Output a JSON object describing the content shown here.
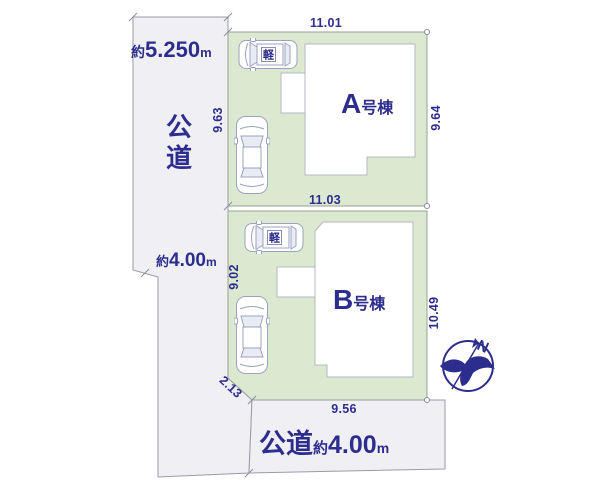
{
  "diagram": {
    "roads": {
      "left": {
        "label_chars": [
          "公",
          "道"
        ],
        "width_top": {
          "approx": "約",
          "value": "5.250",
          "unit": "m"
        },
        "width_mid": {
          "approx": "約",
          "value": "4.00",
          "unit": "m"
        }
      },
      "bottom": {
        "label": "公道",
        "width": {
          "approx": "約",
          "value": "4.00",
          "unit": "m"
        }
      }
    },
    "plots": {
      "a": {
        "building_letter": "A",
        "building_suffix": "号棟",
        "dim_top": "11.01",
        "dim_left": "9.63",
        "dim_right": "9.64"
      },
      "b": {
        "building_letter": "B",
        "building_suffix": "号棟",
        "dim_top": "11.03",
        "dim_left": "9.02",
        "dim_right": "10.49",
        "dim_chamfer": "2.13",
        "dim_bottom": "9.56"
      }
    },
    "vehicles": {
      "kei_plate": "軽"
    },
    "compass": {
      "north": "N"
    },
    "colors": {
      "text_navy": "#2d2d8e",
      "plot_green": "#dbe9d1",
      "road_fill": "#f0f0f4",
      "line_gray": "#9a9aab"
    }
  }
}
